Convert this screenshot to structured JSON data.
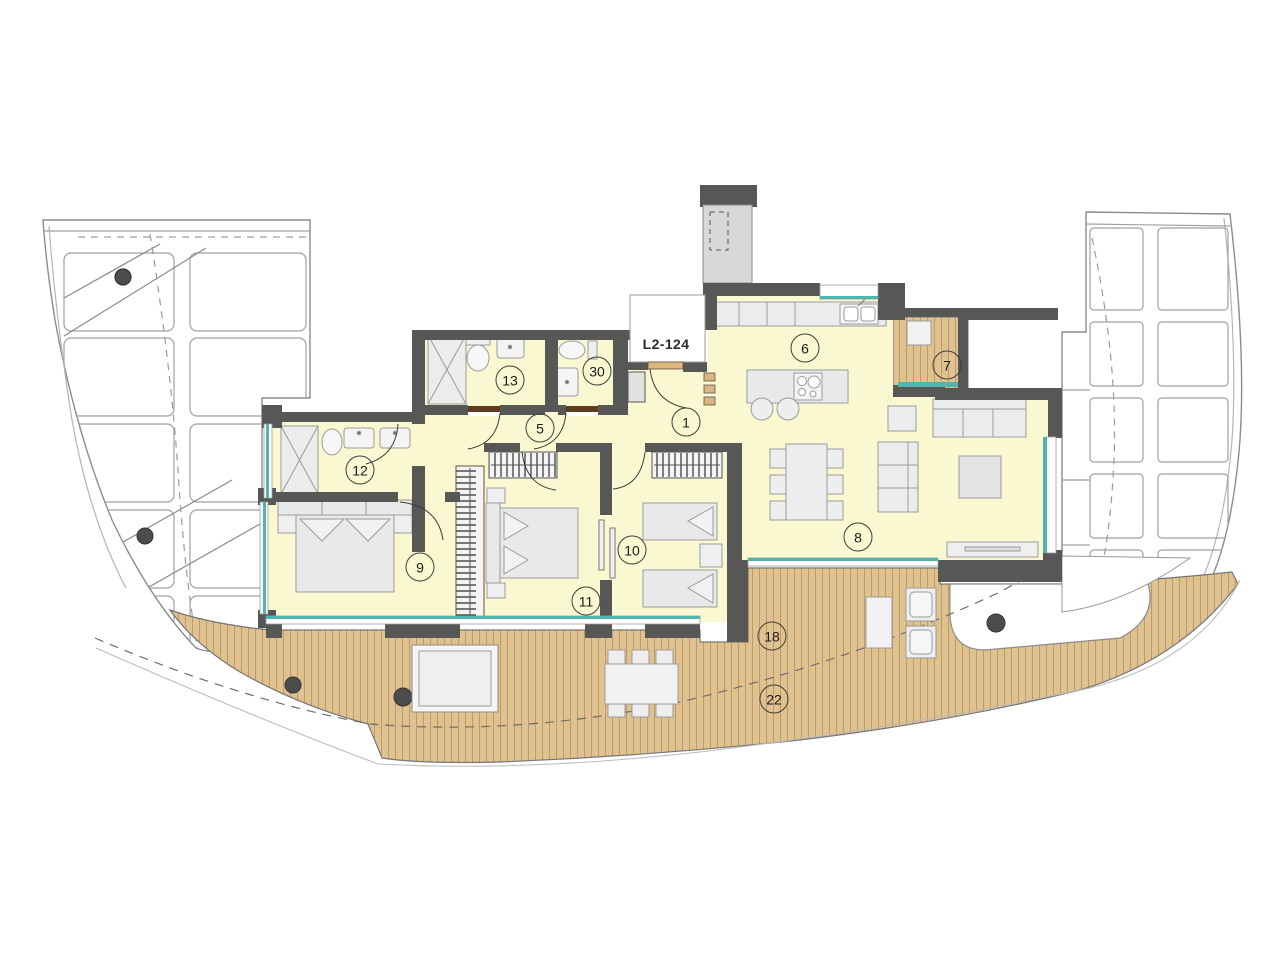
{
  "unit": {
    "label": "L2-124",
    "label_x": 666,
    "label_y": 344
  },
  "room_markers": [
    {
      "label": "1",
      "x": 686,
      "y": 422
    },
    {
      "label": "5",
      "x": 540,
      "y": 428
    },
    {
      "label": "6",
      "x": 805,
      "y": 348
    },
    {
      "label": "7",
      "x": 947,
      "y": 365
    },
    {
      "label": "8",
      "x": 858,
      "y": 537
    },
    {
      "label": "9",
      "x": 420,
      "y": 567
    },
    {
      "label": "10",
      "x": 632,
      "y": 550
    },
    {
      "label": "11",
      "x": 586,
      "y": 601
    },
    {
      "label": "12",
      "x": 360,
      "y": 470
    },
    {
      "label": "13",
      "x": 510,
      "y": 380
    },
    {
      "label": "18",
      "x": 772,
      "y": 636
    },
    {
      "label": "22",
      "x": 774,
      "y": 699
    },
    {
      "label": "30",
      "x": 597,
      "y": 371
    }
  ],
  "colors": {
    "wall": "#575756",
    "floor": "#faf8d0",
    "deck": "#e0c290",
    "deck_line": "#a2814e",
    "glazing": "#4fb5b0",
    "furniture": "#e7e7e7",
    "furniture_stroke": "#9b9b9b",
    "neighbor_line": "#a0a0a0",
    "door_leaf": "#5e3a1e",
    "threshold": "#d9b77f",
    "marker_border": "#3f3f3f"
  }
}
